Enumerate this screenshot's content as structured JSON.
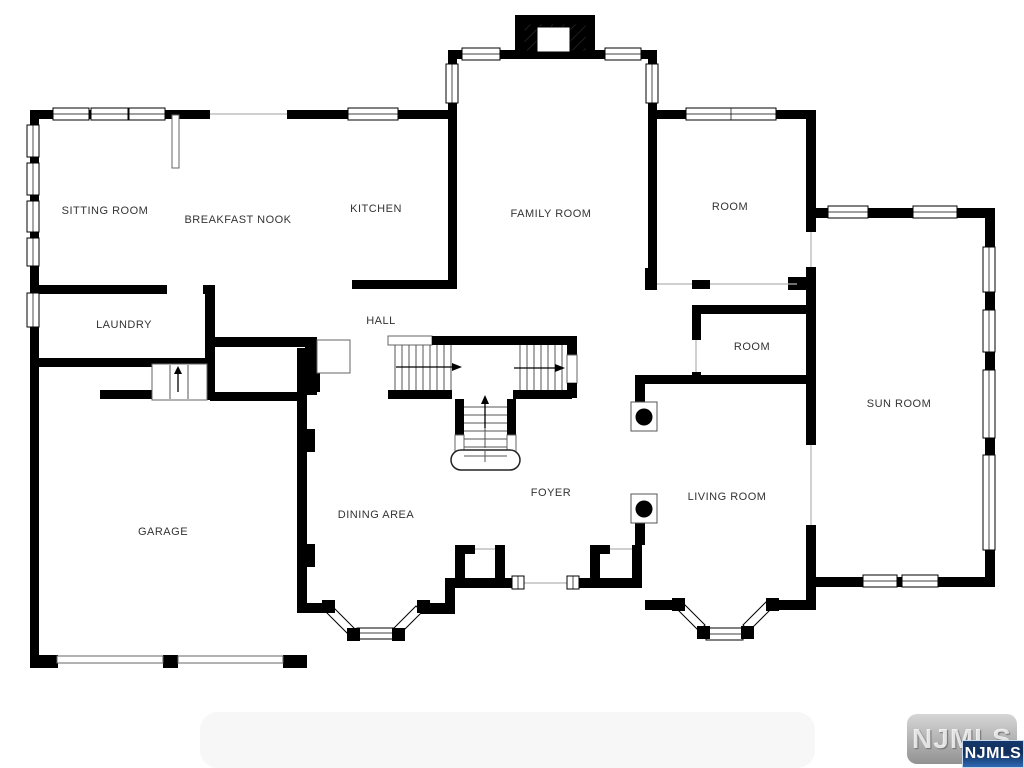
{
  "floorplan": {
    "rooms": [
      {
        "id": "sitting-room",
        "label": "SITTING ROOM"
      },
      {
        "id": "breakfast-nook",
        "label": "BREAKFAST NOOK"
      },
      {
        "id": "kitchen",
        "label": "KITCHEN"
      },
      {
        "id": "family-room",
        "label": "FAMILY ROOM"
      },
      {
        "id": "room-upper",
        "label": "ROOM"
      },
      {
        "id": "laundry",
        "label": "LAUNDRY"
      },
      {
        "id": "hall",
        "label": "HALL"
      },
      {
        "id": "room-middle",
        "label": "ROOM"
      },
      {
        "id": "sun-room",
        "label": "SUN ROOM"
      },
      {
        "id": "garage",
        "label": "GARAGE"
      },
      {
        "id": "dining-area",
        "label": "DINING AREA"
      },
      {
        "id": "foyer",
        "label": "FOYER"
      },
      {
        "id": "living-room",
        "label": "LIVING ROOM"
      }
    ],
    "watermark": {
      "logo_text": "NJMLS",
      "badge_text": "NJMLS"
    },
    "colors": {
      "wall": "#000000",
      "badge_blue": "#1e4f96",
      "label_text": "#333333"
    }
  }
}
